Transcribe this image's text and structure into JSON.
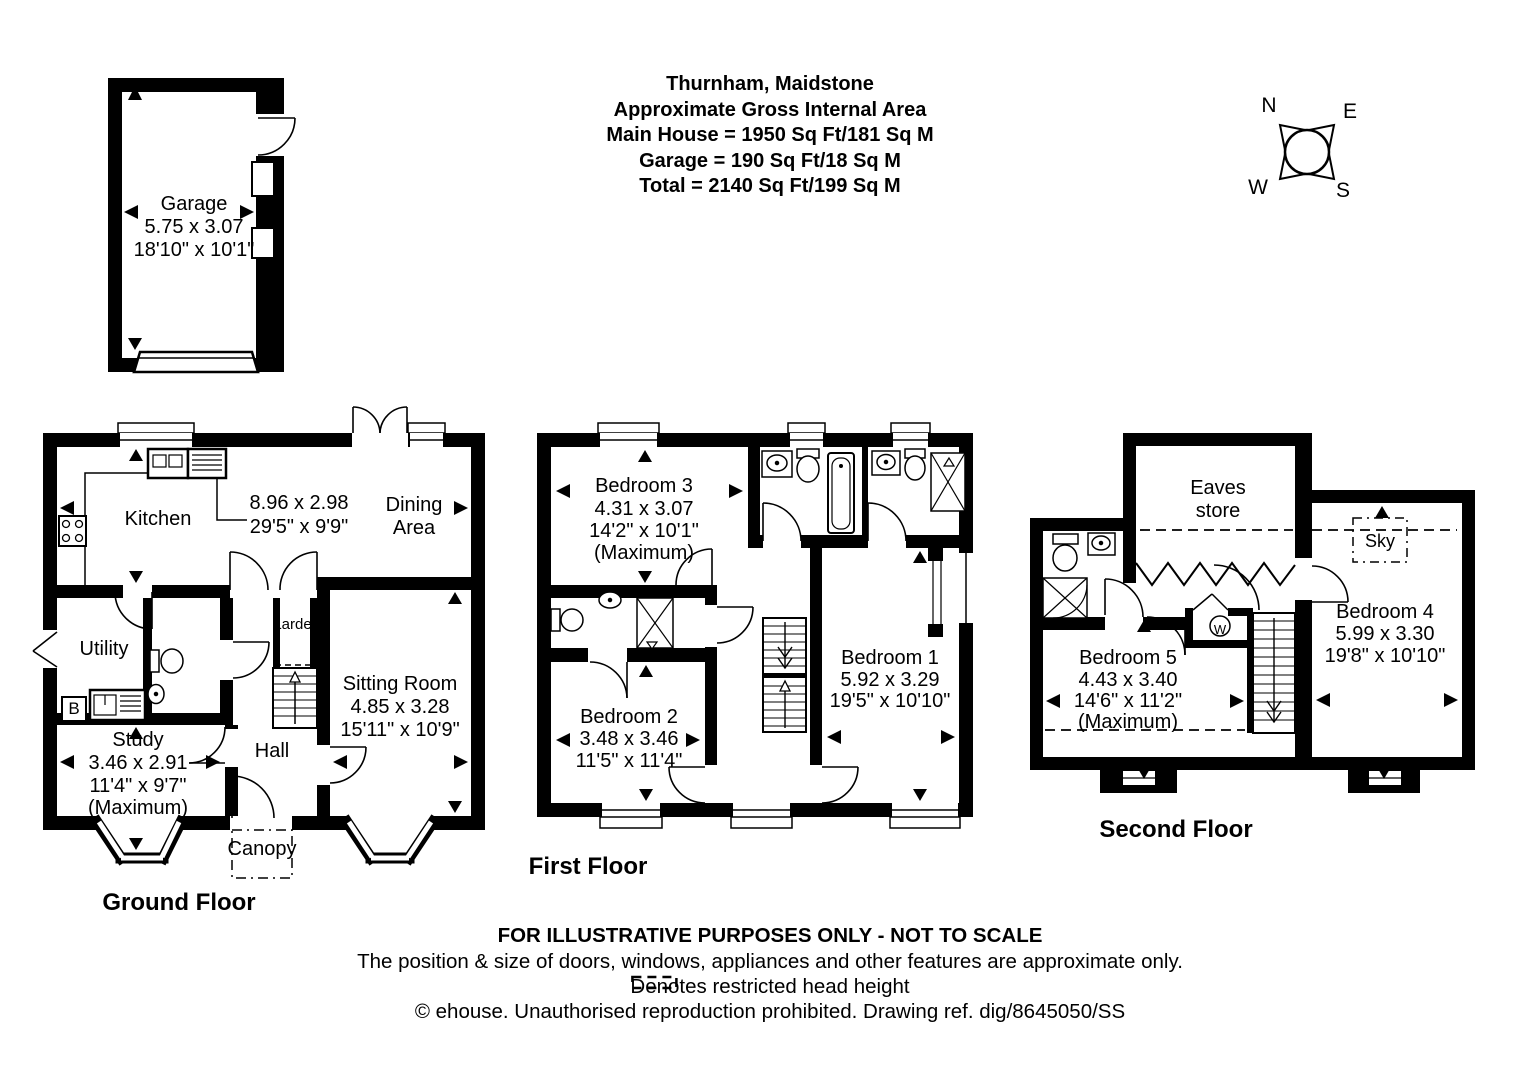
{
  "title": {
    "lines": [
      "Thurnham, Maidstone",
      "Approximate Gross Internal Area",
      "Main House = 1950 Sq Ft/181 Sq M",
      "Garage = 190 Sq Ft/18 Sq M",
      "Total = 2140 Sq Ft/199 Sq M"
    ]
  },
  "compass": {
    "n": "N",
    "e": "E",
    "w": "W",
    "s": "S"
  },
  "garage": {
    "name": "Garage",
    "metric": "5.75 x 3.07",
    "imperial": "18'10\" x 10'1\""
  },
  "ground_floor": {
    "floor_label": "Ground Floor",
    "kitchen": {
      "name": "Kitchen"
    },
    "kitchen_dining_dims": {
      "metric": "8.96 x 2.98",
      "imperial": "29'5\" x 9'9\""
    },
    "dining": {
      "line1": "Dining",
      "line2": "Area"
    },
    "utility": {
      "name": "Utility"
    },
    "larder": {
      "name": "Larder"
    },
    "boiler": "B",
    "sitting_room": {
      "name": "Sitting Room",
      "metric": "4.85 x 3.28",
      "imperial": "15'11\" x 10'9\""
    },
    "study": {
      "name": "Study",
      "metric": "3.46 x 2.91",
      "imperial": "11'4\" x 9'7\"",
      "note": "(Maximum)"
    },
    "hall": {
      "name": "Hall"
    },
    "canopy": {
      "name": "Canopy"
    }
  },
  "first_floor": {
    "floor_label": "First Floor",
    "bedroom3": {
      "name": "Bedroom 3",
      "metric": "4.31 x 3.07",
      "imperial": "14'2\" x 10'1\"",
      "note": "(Maximum)"
    },
    "bedroom2": {
      "name": "Bedroom 2",
      "metric": "3.48 x 3.46",
      "imperial": "11'5\" x 11'4\""
    },
    "bedroom1": {
      "name": "Bedroom 1",
      "metric": "5.92 x 3.29",
      "imperial": "19'5\" x 10'10\""
    }
  },
  "second_floor": {
    "floor_label": "Second Floor",
    "eaves_store": {
      "line1": "Eaves",
      "line2": "store"
    },
    "skylight": "Sky",
    "washer": "W",
    "bedroom5": {
      "name": "Bedroom 5",
      "metric": "4.43 x 3.40",
      "imperial": "14'6\" x 11'2\"",
      "note": "(Maximum)"
    },
    "bedroom4": {
      "name": "Bedroom 4",
      "metric": "5.99 x 3.30",
      "imperial": "19'8\" x 10'10\""
    }
  },
  "footer": {
    "line1": "FOR ILLUSTRATIVE PURPOSES ONLY - NOT TO SCALE",
    "line2": "The position & size of doors, windows, appliances and other features are approximate only.",
    "line3": "Denotes restricted head height",
    "line4": "© ehouse. Unauthorised reproduction prohibited. Drawing ref. dig/8645050/SS"
  }
}
